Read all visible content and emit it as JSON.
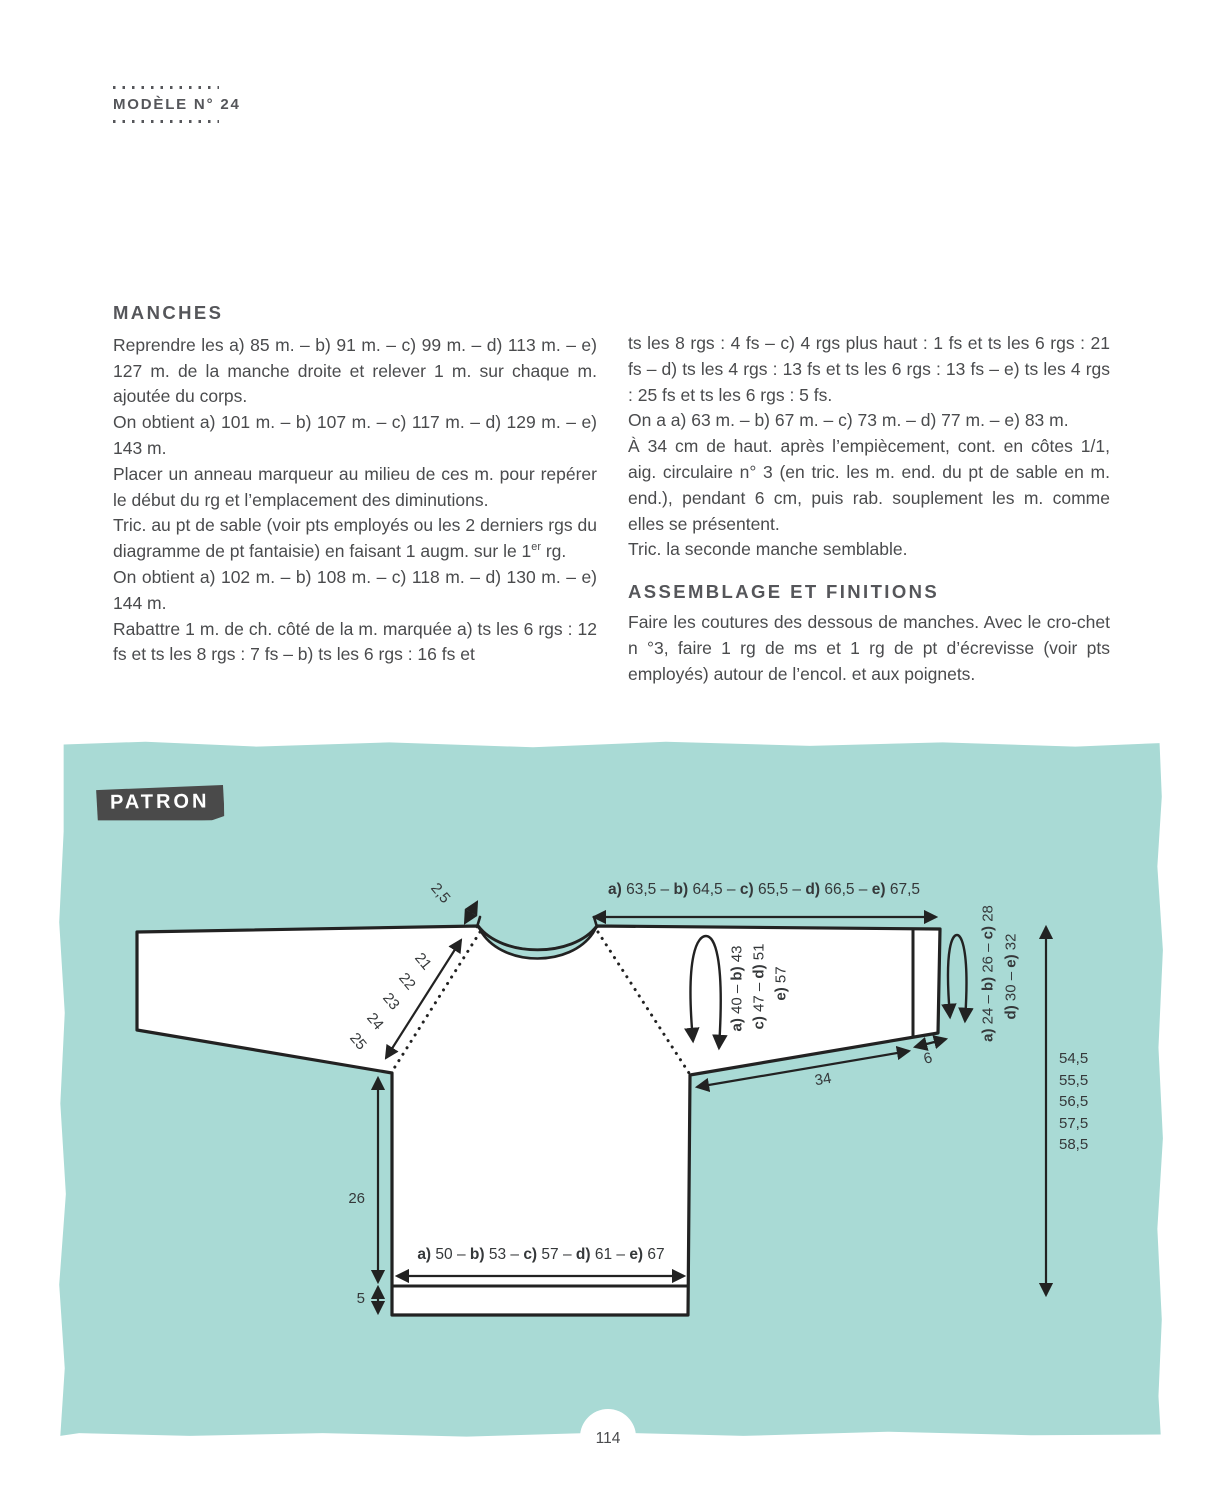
{
  "header": {
    "title": "MODÈLE N° 24"
  },
  "page_number": "114",
  "colors": {
    "teal": "#a9dad5",
    "ink": "#4a4b4d",
    "line": "#222222",
    "patron_bg": "#4a4a4a"
  },
  "manches": {
    "title": "MANCHES",
    "paragraphs": [
      "Reprendre les a) 85 m. – b) 91 m. – c) 99 m. – d) 113 m. – e) 127 m. de la manche droite et relever 1 m. sur chaque m. ajoutée du corps.",
      "On obtient a) 101 m. – b) 107 m. – c) 117 m. – d) 129 m. – e) 143 m.",
      "Placer un anneau marqueur au milieu de ces m. pour repérer le début du rg et l’emplacement des diminutions.",
      "Tric. au pt de sable (voir pts employés ou les 2 derniers rgs du diagramme de pt fantaisie) en faisant 1 augm. sur le 1er rg.",
      "On obtient a) 102 m. – b) 108 m. – c) 118 m. – d) 130 m. – e) 144 m.",
      "Rabattre 1 m. de ch. côté de la m. marquée a) ts les 6 rgs : 12 fs et ts les 8 rgs : 7 fs – b) ts les 6 rgs : 16 fs et"
    ]
  },
  "manches_suite": {
    "paragraphs": [
      "ts les 8 rgs : 4 fs – c) 4 rgs plus haut : 1 fs et ts les 6 rgs : 21 fs – d) ts les 4 rgs : 13 fs et ts les 6 rgs : 13 fs – e) ts les 4 rgs : 25 fs et ts les 6 rgs : 5 fs.",
      "On a a) 63 m. – b) 67 m. – c) 73 m. – d) 77 m. – e) 83 m.",
      "À 34 cm de haut. après l’empiècement, cont. en côtes 1/1, aig. circulaire n° 3 (en tric. les m. end. du pt de sable en m. end.), pendant 6 cm, puis rab. souplement les m. comme elles se présentent.",
      "Tric. la seconde manche semblable."
    ]
  },
  "finitions": {
    "title": "ASSEMBLAGE ET FINITIONS",
    "paragraphs": [
      "Faire les coutures des dessous de manches. Avec le cro-chet n °3, faire 1 rg de ms et 1 rg de pt d’écrevisse (voir pts employés) autour de l’encol. et aux poignets."
    ]
  },
  "patron": {
    "label": "PATRON"
  },
  "diagram": {
    "neckband_height": "2,5",
    "yoke_width_top": "a) 63,5 – b) 64,5 – c) 65,5 – d) 66,5 – e) 67,5",
    "raglan_lengths": [
      "21",
      "22",
      "23",
      "24",
      "25"
    ],
    "upper_arm_line1": "a) 40 – b) 43",
    "upper_arm_line2": "c) 47 – d) 51",
    "upper_arm_line3": "e) 57",
    "sleeve_length": "34",
    "cuff_height": "6",
    "cuff_line1": "a) 24 – b) 26 – c) 28",
    "cuff_line2": "d) 30 – e) 32",
    "total_heights": [
      "54,5",
      "55,5",
      "56,5",
      "57,5",
      "58,5"
    ],
    "body_height": "26",
    "rib_height": "5",
    "body_width": "a) 50 – b) 53 – c) 57 – d) 61 – e) 67"
  }
}
